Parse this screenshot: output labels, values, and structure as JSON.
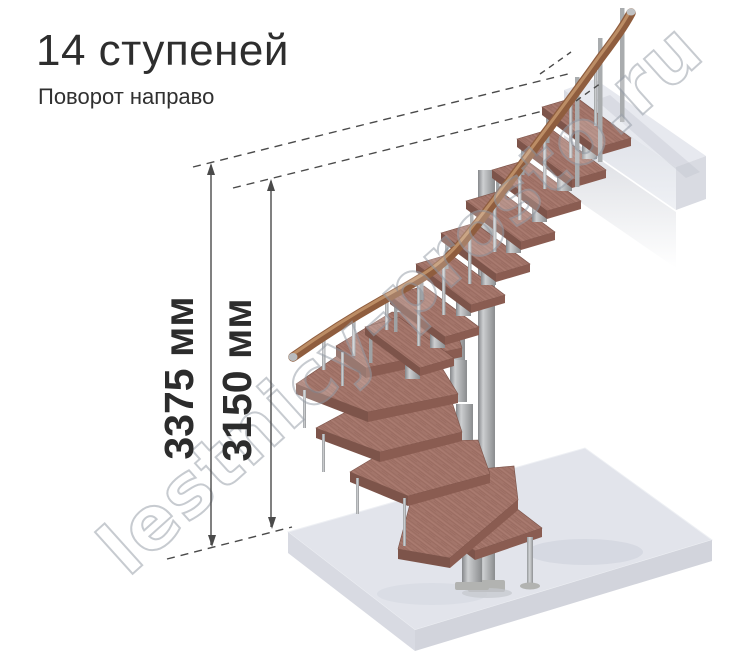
{
  "header": {
    "title": "14 ступеней",
    "subtitle": "Поворот направо"
  },
  "dimensions": {
    "total_height": "3375 мм",
    "flight_height": "3150 мм"
  },
  "watermark": {
    "text": "lestnicy-prosto.ru"
  },
  "colors": {
    "wood_top": "#a3756a",
    "wood_front": "#7d544a",
    "wood_side": "#8a5c51",
    "handrail": "#8f5d3e",
    "metal": "#b5b8ba",
    "floor_slab": "#e2e4eb",
    "dimension_lines": "#4a4a4a",
    "title_text": "#2e2e2e"
  }
}
